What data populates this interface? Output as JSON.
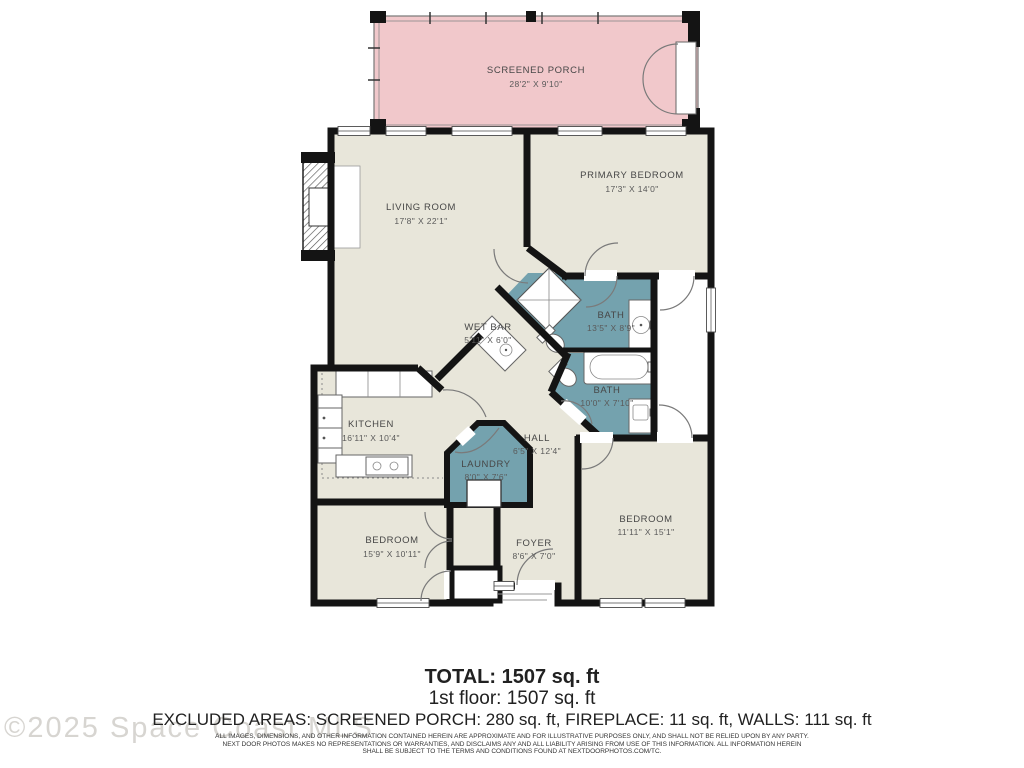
{
  "plan": {
    "rooms": [
      {
        "name": "SCREENED PORCH",
        "dims": "28'2\" X 9'10\""
      },
      {
        "name": "LIVING ROOM",
        "dims": "17'8\" X 22'1\""
      },
      {
        "name": "PRIMARY BEDROOM",
        "dims": "17'3\" X 14'0\""
      },
      {
        "name": "BATH",
        "dims": "13'5\" X 8'9\""
      },
      {
        "name": "BATH",
        "dims": "10'0\" X 7'10\""
      },
      {
        "name": "WET BAR",
        "dims": "5'11\" X 6'0\""
      },
      {
        "name": "KITCHEN",
        "dims": "16'11\" X 10'4\""
      },
      {
        "name": "HALL",
        "dims": "6'5\" X 12'4\""
      },
      {
        "name": "LAUNDRY",
        "dims": "8'0\" X 7'6\""
      },
      {
        "name": "BEDROOM",
        "dims": "15'9\" X 10'11\""
      },
      {
        "name": "FOYER",
        "dims": "8'6\" X 7'0\""
      },
      {
        "name": "BEDROOM",
        "dims": "11'11\" X 15'1\""
      }
    ],
    "colors": {
      "room_fill": "#e8e6da",
      "bath_fill": "#74a2ae",
      "porch_fill": "#f1c8cb",
      "wall": "#141414",
      "label": "#474747"
    }
  },
  "summary": {
    "total": "TOTAL: 1507 sq. ft",
    "first_floor": "1st floor: 1507 sq. ft",
    "excluded": "EXCLUDED AREAS: SCREENED PORCH: 280 sq. ft, FIREPLACE: 11 sq. ft, WALLS: 111 sq. ft"
  },
  "disclaimer": {
    "line1": "ALL IMAGES, DIMENSIONS, AND OTHER INFORMATION CONTAINED HEREIN ARE APPROXIMATE AND FOR ILLUSTRATIVE PURPOSES ONLY, AND SHALL NOT BE RELIED UPON BY ANY PARTY.",
    "line2": "NEXT DOOR PHOTOS MAKES NO REPRESENTATIONS OR WARRANTIES, AND DISCLAIMS ANY AND ALL LIABILITY ARISING FROM USE OF THIS INFORMATION. ALL INFORMATION HEREIN",
    "line3": "SHALL BE SUBJECT TO THE TERMS AND CONDITIONS FOUND AT NEXTDOORPHOTOS.COM/TC."
  },
  "watermark": "©2025 Space Coast MLS"
}
